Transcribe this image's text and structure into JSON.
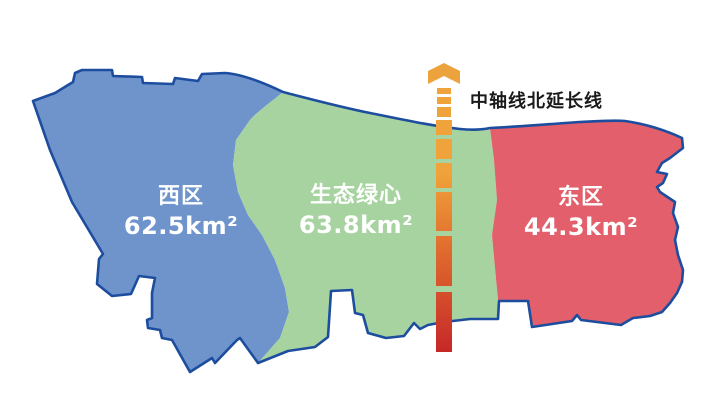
{
  "map": {
    "background_color": "#ffffff",
    "outline_color": "#1d4d9e",
    "region_label_color": "#ffffff",
    "regions": [
      {
        "name": "西区",
        "area": "62.5km²",
        "color": "#6e94cb"
      },
      {
        "name": "生态绿心",
        "area": "63.8km²",
        "color": "#a7d3a0"
      },
      {
        "name": "东区",
        "area": "44.3km²",
        "color": "#e25f6b"
      }
    ],
    "axis": {
      "label": "中轴线北延长线",
      "label_color": "#1a1a1a",
      "arrow_color": "#eda33d",
      "color_top": "#f0a33a",
      "color_mid": "#e06a2e",
      "color_bottom": "#c62828"
    }
  }
}
